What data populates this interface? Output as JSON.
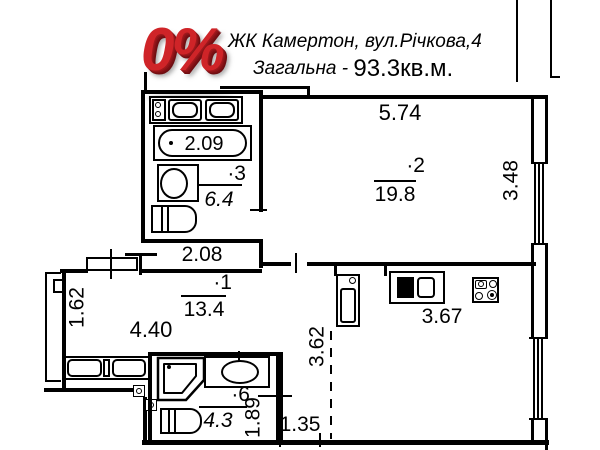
{
  "header": {
    "logo_text": "0%",
    "address": "ЖК Камертон, вул.Річкова,4",
    "total_label": "Загальна - ",
    "total_value": "93.3кв.м."
  },
  "rooms": {
    "living": {
      "number": "·2",
      "area": "19.8"
    },
    "room1": {
      "number": "·1",
      "area": "13.4"
    },
    "bath3": {
      "number": "·3",
      "area": "6.4"
    },
    "bath6": {
      "number": "·6",
      "area": "4.3"
    }
  },
  "dims": {
    "room2_width": "5.74",
    "room2_height": "3.48",
    "bathtub_length": "2.09",
    "hall_width": "2.08",
    "room1_width": "4.40",
    "room1_side": "1.62",
    "kitchen_width": "3.67",
    "kitchen_height": "3.62",
    "bath6_side": "1.89",
    "hall2_width": "1.35"
  },
  "colors": {
    "line": "#000000",
    "logo_red": "#cf2428",
    "background": "#ffffff"
  }
}
